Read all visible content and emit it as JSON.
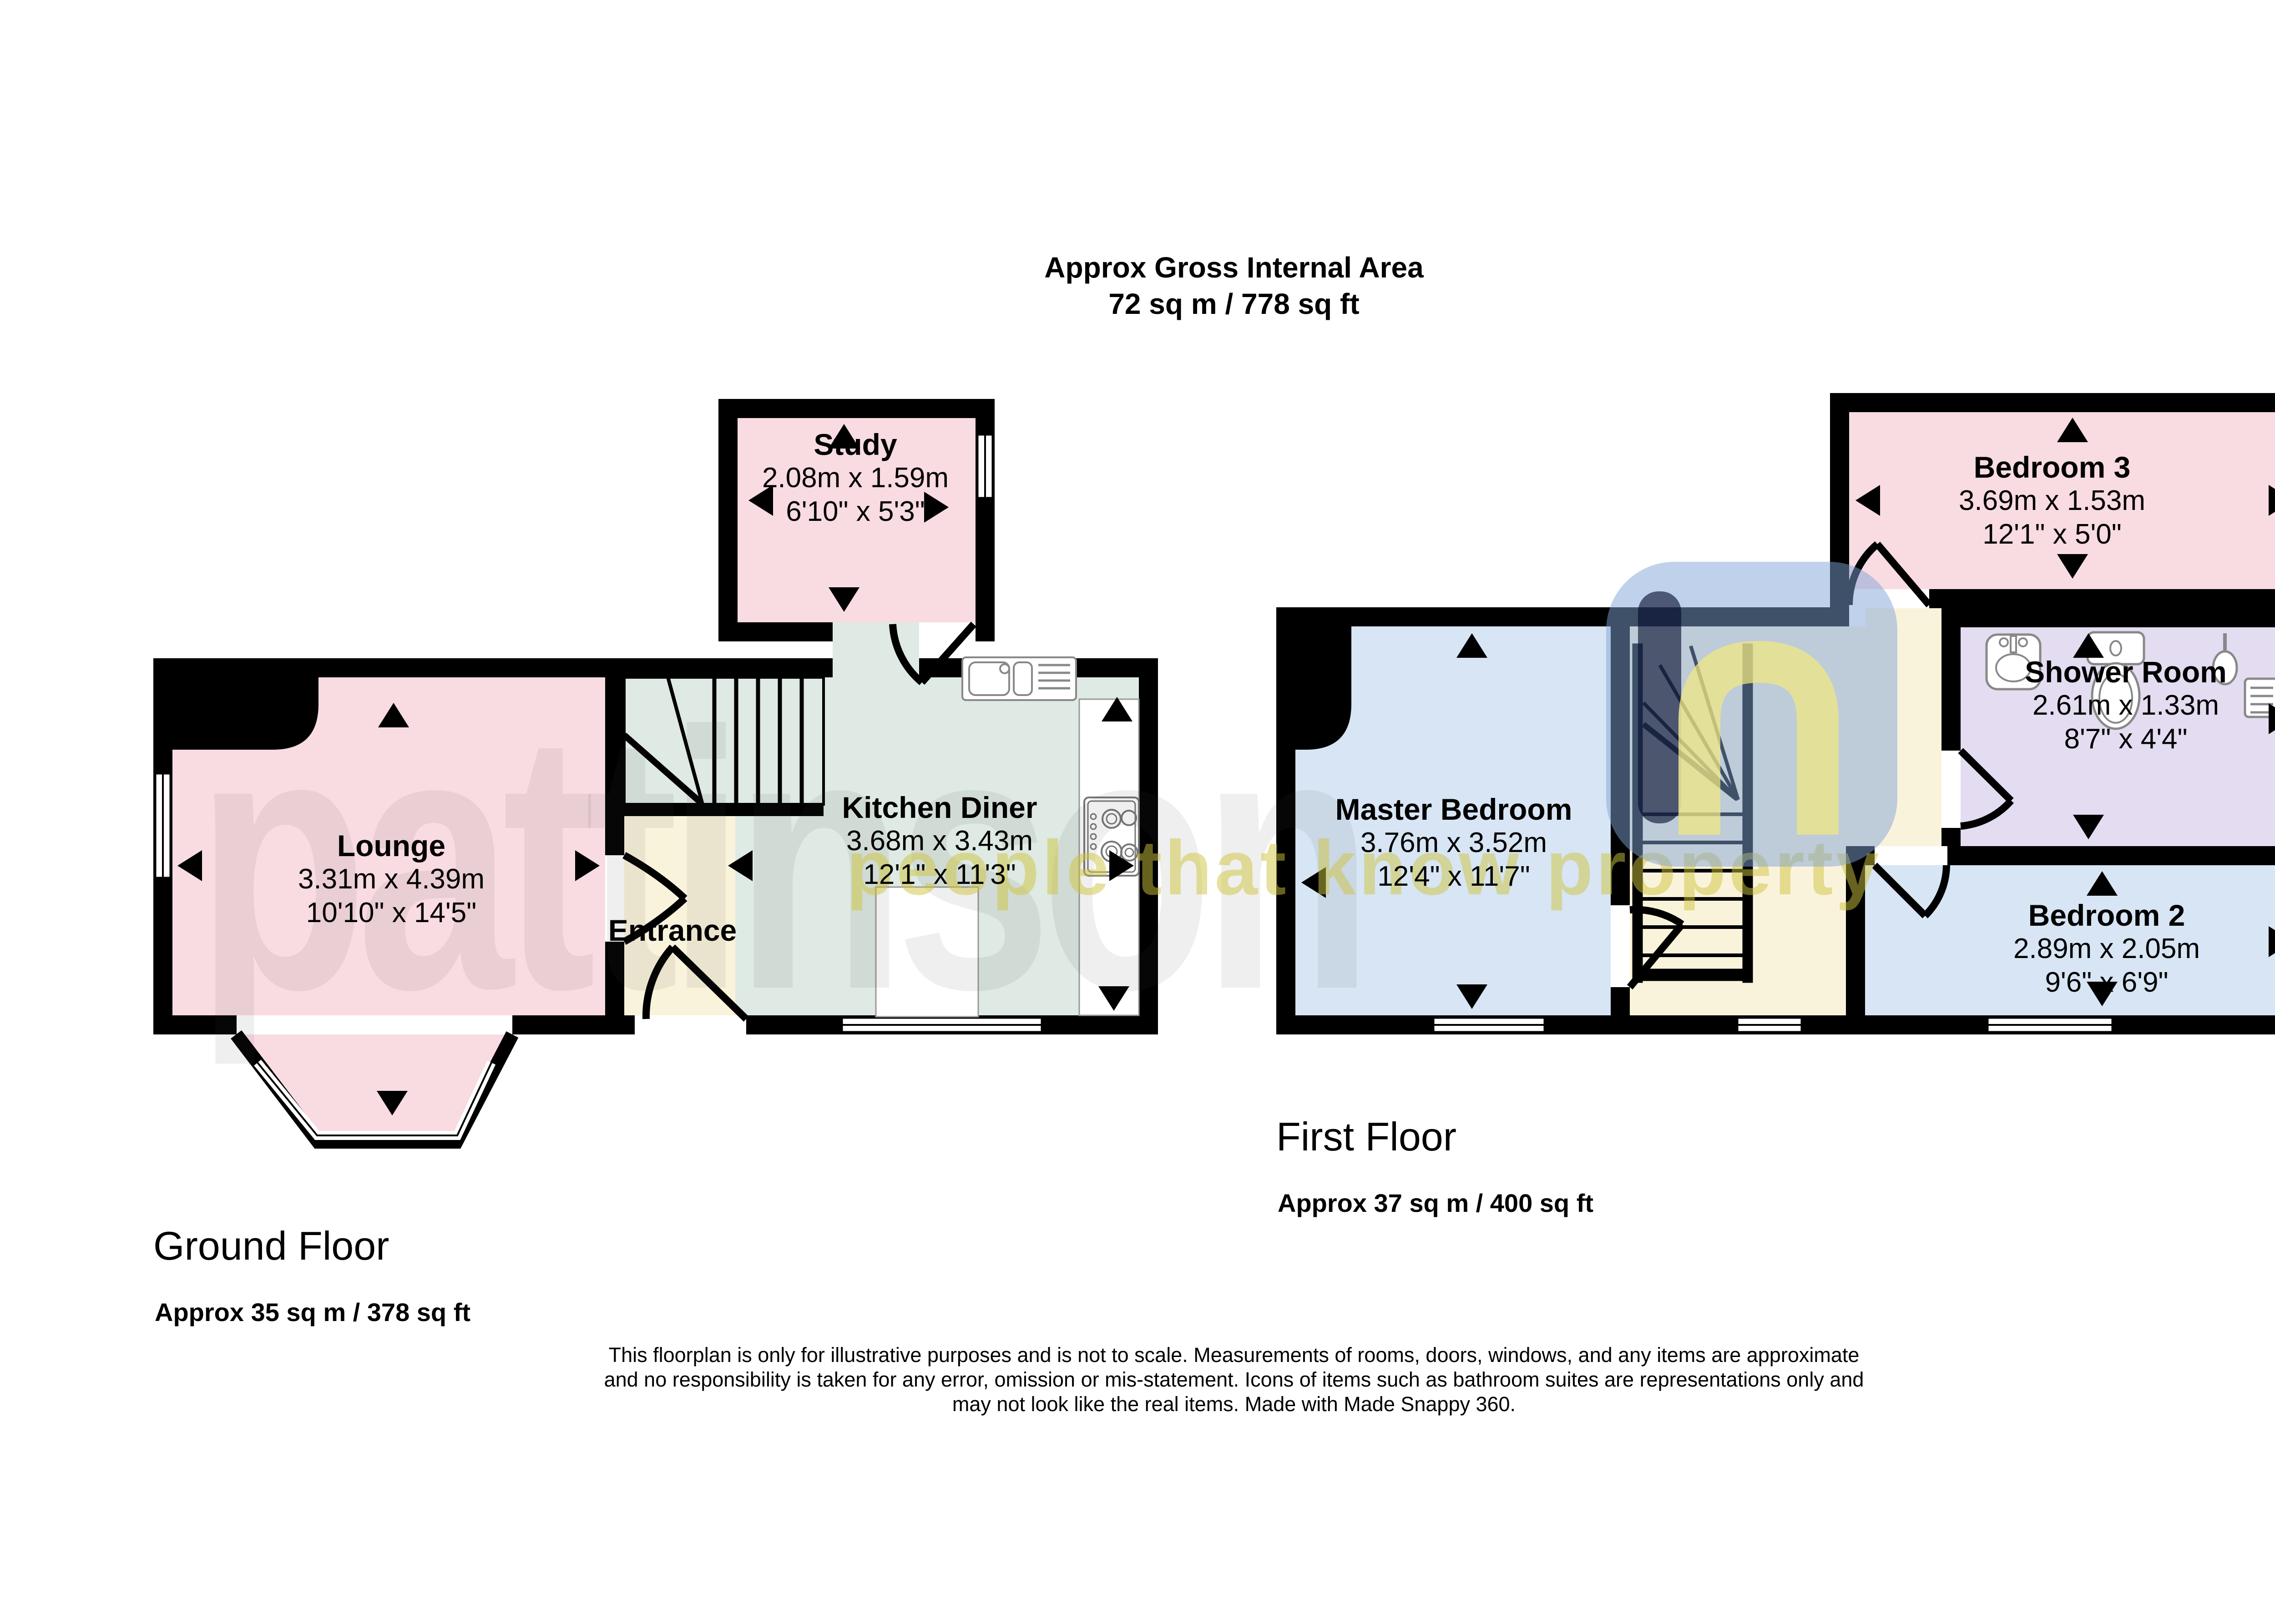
{
  "title": {
    "line1": "Approx Gross Internal Area",
    "line2": "72 sq m / 778 sq ft"
  },
  "watermark": {
    "brand": "pattinson",
    "tagline": "people that know property"
  },
  "ground_floor": {
    "label": "Ground Floor",
    "area": "Approx 35 sq m / 378 sq ft",
    "rooms": [
      {
        "name": "Study",
        "metric": "2.08m x 1.59m",
        "imperial": "6'10\" x 5'3\""
      },
      {
        "name": "Lounge",
        "metric": "3.31m x 4.39m",
        "imperial": "10'10\" x 14'5\""
      },
      {
        "name": "Entrance",
        "metric": "",
        "imperial": ""
      },
      {
        "name": "Kitchen Diner",
        "metric": "3.68m x 3.43m",
        "imperial": "12'1\" x 11'3\""
      }
    ]
  },
  "first_floor": {
    "label": "First Floor",
    "area": "Approx 37 sq m / 400 sq ft",
    "rooms": [
      {
        "name": "Master Bedroom",
        "metric": "3.76m x 3.52m",
        "imperial": "12'4\" x 11'7\""
      },
      {
        "name": "Bedroom 3",
        "metric": "3.69m x 1.53m",
        "imperial": "12'1\" x 5'0\""
      },
      {
        "name": "Shower Room",
        "metric": "2.61m x 1.33m",
        "imperial": "8'7\" x 4'4\""
      },
      {
        "name": "Bedroom 2",
        "metric": "2.89m x 2.05m",
        "imperial": "9'6\" x 6'9\""
      }
    ]
  },
  "disclaimer": {
    "line1": "This floorplan is only for illustrative purposes and is not to scale. Measurements of rooms, doors, windows, and any items are approximate",
    "line2": "and no responsibility is taken for any error, omission or mis-statement. Icons of items such as bathroom suites are representations only and",
    "line3": "may not look like the real items. Made with Made Snappy 360."
  },
  "colors": {
    "room_pink": "#F9DBE2",
    "room_green": "#DEEAE3",
    "room_cream": "#FAF3DC",
    "room_blue": "#D7E5F4",
    "room_lavender": "#E4DCF0",
    "wall": "#000000",
    "watermark_yellow": "#D6CB3C",
    "watermark_blue": "#7FA3D6"
  }
}
